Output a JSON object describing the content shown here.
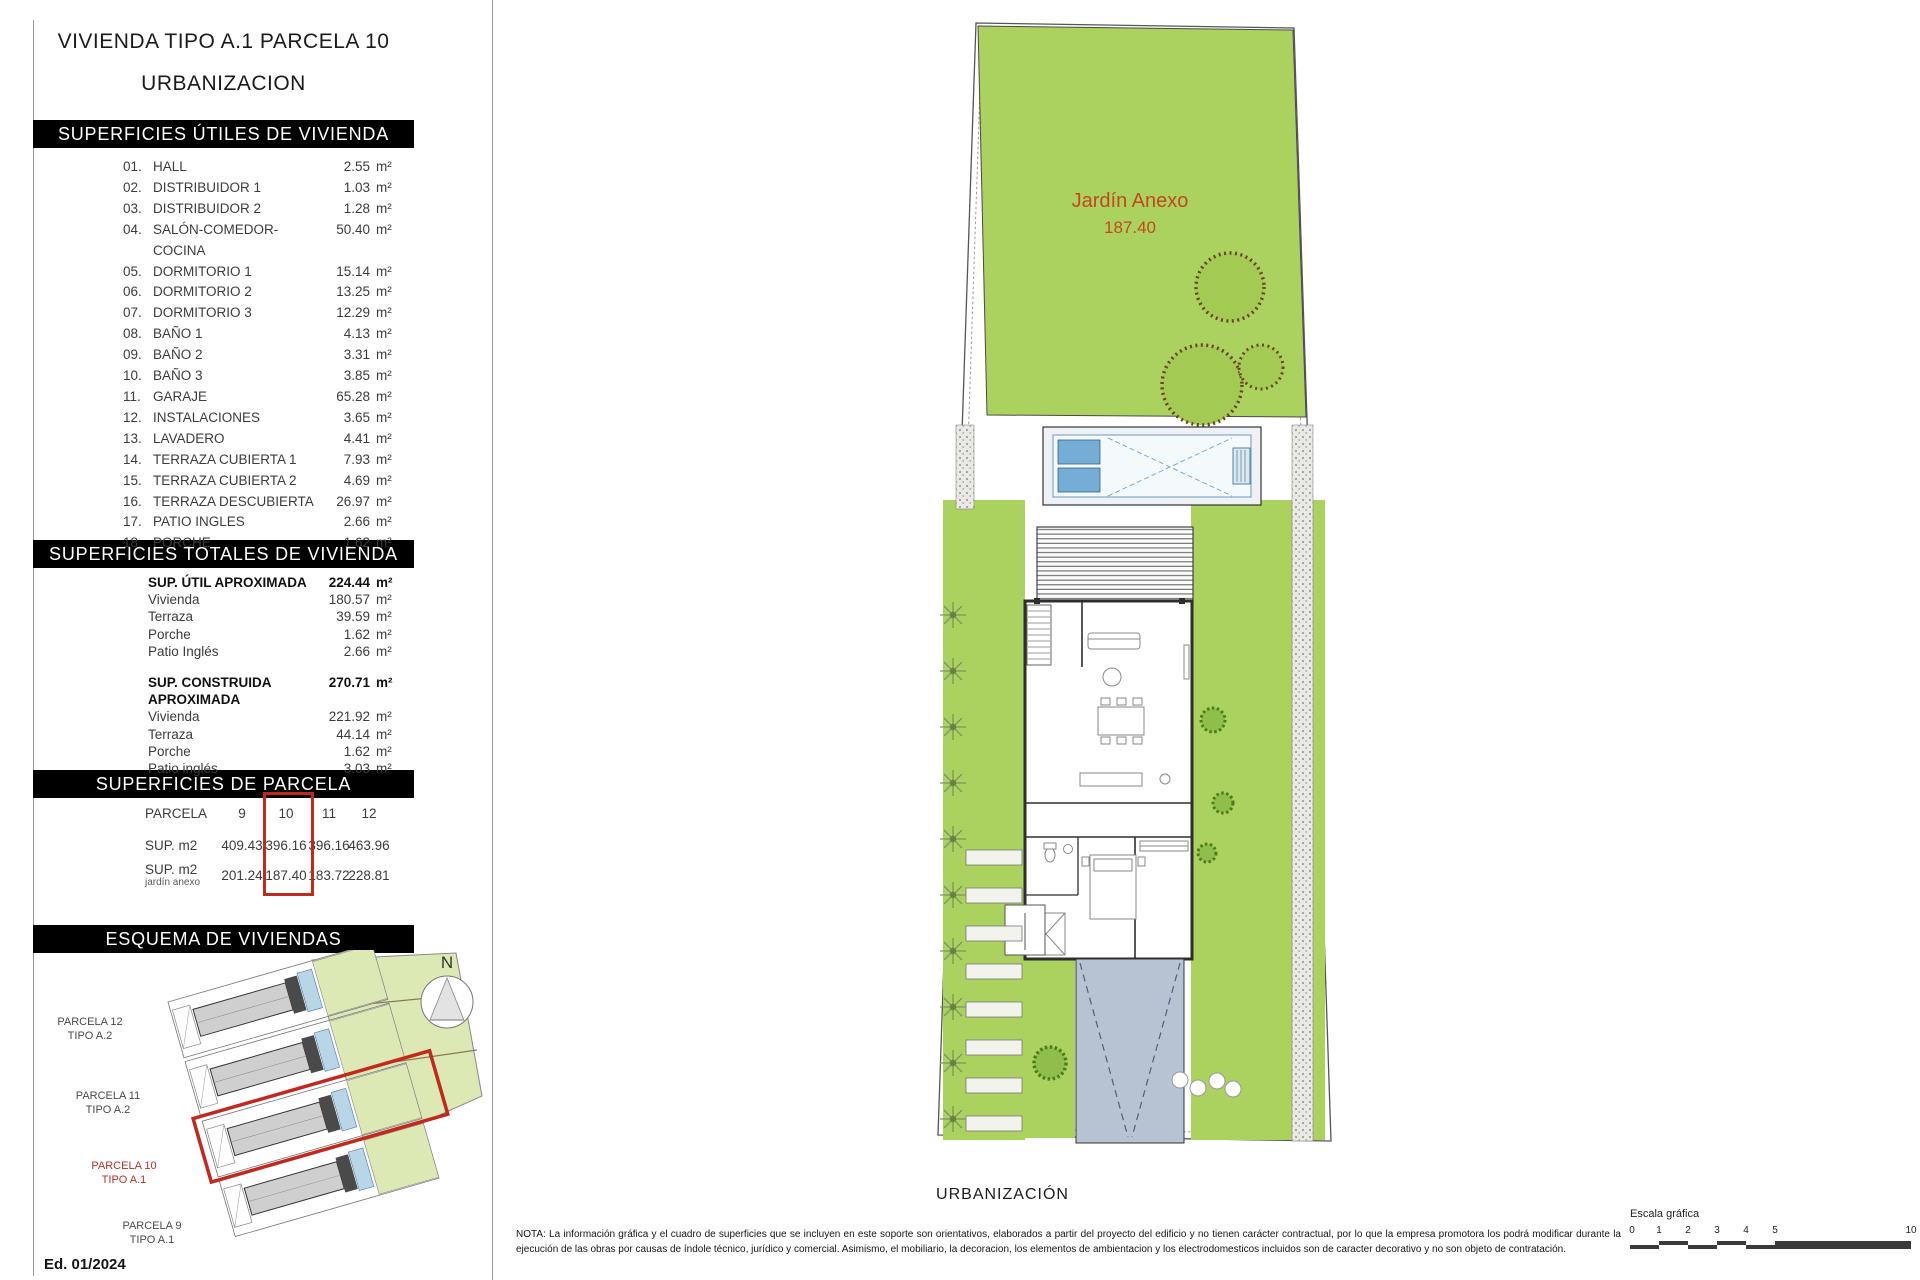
{
  "page": {
    "title1": "VIVIENDA TIPO A.1 PARCELA 10",
    "title2": "URBANIZACION",
    "edition": "Ed. 01/2024"
  },
  "useful": {
    "header": "SUPERFICIES ÚTILES DE VIVIENDA",
    "unit": "m²",
    "items": [
      {
        "num": "01.",
        "label": "HALL",
        "value": "2.55"
      },
      {
        "num": "02.",
        "label": "DISTRIBUIDOR 1",
        "value": "1.03"
      },
      {
        "num": "03.",
        "label": "DISTRIBUIDOR 2",
        "value": "1.28"
      },
      {
        "num": "04.",
        "label": "SALÓN-COMEDOR-COCINA",
        "value": "50.40"
      },
      {
        "num": "05.",
        "label": "DORMITORIO 1",
        "value": "15.14"
      },
      {
        "num": "06.",
        "label": "DORMITORIO 2",
        "value": "13.25"
      },
      {
        "num": "07.",
        "label": "DORMITORIO 3",
        "value": "12.29"
      },
      {
        "num": "08.",
        "label": "BAÑO 1",
        "value": "4.13"
      },
      {
        "num": "09.",
        "label": "BAÑO 2",
        "value": "3.31"
      },
      {
        "num": "10.",
        "label": "BAÑO 3",
        "value": "3.85"
      },
      {
        "num": "11.",
        "label": "GARAJE",
        "value": "65.28"
      },
      {
        "num": "12.",
        "label": "INSTALACIONES",
        "value": "3.65"
      },
      {
        "num": "13.",
        "label": "LAVADERO",
        "value": "4.41"
      },
      {
        "num": "14.",
        "label": "TERRAZA CUBIERTA 1",
        "value": "7.93"
      },
      {
        "num": "15.",
        "label": "TERRAZA CUBIERTA 2",
        "value": "4.69"
      },
      {
        "num": "16.",
        "label": "TERRAZA DESCUBIERTA",
        "value": "26.97"
      },
      {
        "num": "17.",
        "label": "PATIO INGLES",
        "value": "2.66"
      },
      {
        "num": "18.",
        "label": "PORCHE",
        "value": "1.62"
      }
    ]
  },
  "totals": {
    "header": "SUPERFICIES TOTALES DE VIVIENDA",
    "unit": "m²",
    "util": {
      "label": "SUP. ÚTIL APROXIMADA",
      "value": "224.44",
      "rows": [
        {
          "label": "Vivienda",
          "value": "180.57"
        },
        {
          "label": "Terraza",
          "value": "39.59"
        },
        {
          "label": "Porche",
          "value": "1.62"
        },
        {
          "label": "Patio Inglés",
          "value": "2.66"
        }
      ]
    },
    "construida": {
      "label": "SUP. CONSTRUIDA APROXIMADA",
      "value": "270.71",
      "rows": [
        {
          "label": "Vivienda",
          "value": "221.92"
        },
        {
          "label": "Terraza",
          "value": "44.14"
        },
        {
          "label": "Porche",
          "value": "1.62"
        },
        {
          "label": "Patio inglés",
          "value": "3.03"
        }
      ]
    }
  },
  "parcela": {
    "header": "SUPERFICIES DE PARCELA",
    "row1_label": "PARCELA",
    "row2_label": "SUP. m2",
    "row3_label": "SUP. m2",
    "row3_sub": "jardín anexo",
    "columns": [
      "9",
      "10",
      "11",
      "12"
    ],
    "sup": [
      "409.43",
      "396.16",
      "396.16",
      "463.96"
    ],
    "jardin": [
      "201.24",
      "187.40",
      "183.72",
      "228.81"
    ],
    "highlighted_column": "10"
  },
  "esquema": {
    "header": "ESQUEMA DE VIVIENDAS",
    "north": "N",
    "labels": [
      [
        "PARCELA 12",
        "TIPO A.2"
      ],
      [
        "PARCELA 11",
        "TIPO A.2"
      ],
      [
        "PARCELA 10",
        "TIPO A.1"
      ],
      [
        "PARCELA 9",
        "TIPO A.1"
      ]
    ]
  },
  "plan": {
    "garden_label": "Jardín Anexo",
    "garden_value": "187.40",
    "caption": "URBANIZACIÓN"
  },
  "nota": "NOTA: La información gráfica y el cuadro de superficies que se incluyen en este soporte son orientativos, elaborados a partir del proyecto del edificio y no tienen carácter contractual, por lo que la empresa promotora los podrá modificar durante la ejecución de las obras por causas de índole técnico, jurídico y comercial. Asimismo, el mobiliario, la decoracion, los elementos de ambientacion y los electrodomesticos incluidos son de caracter decorativo y no son objeto de contratación.",
  "escala": {
    "label": "Escala gráfica",
    "ticks": [
      "0",
      "1",
      "2",
      "3",
      "4",
      "5",
      "10"
    ]
  },
  "colors": {
    "grass": "#abd25e",
    "light_grass": "#dce9b4",
    "accent_red": "#c3281c",
    "garden_text": "#bf4a1e",
    "pool_blue": "#76add6",
    "driveway": "#b7c3d3"
  }
}
